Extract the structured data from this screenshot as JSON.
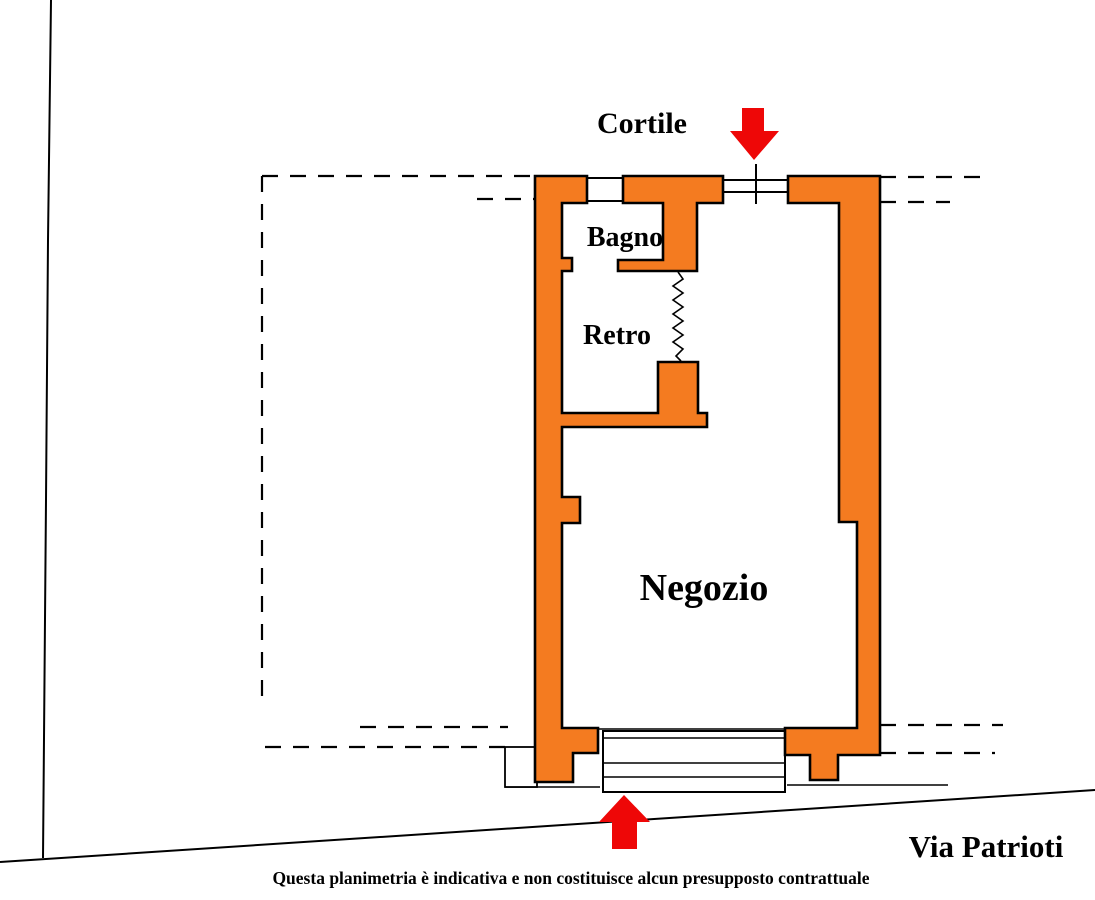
{
  "plan": {
    "labels": {
      "courtyard": "Cortile",
      "bathroom": "Bagno",
      "back_room": "Retro",
      "shop": "Negozio",
      "street": "Via Patrioti"
    },
    "disclaimer": "Questa planimetria è indicativa e non costituisce alcun presupposto contrattuale"
  },
  "colors": {
    "wall_fill": "#F47B20",
    "wall_outline": "#000000",
    "arrow_red": "#EE0707",
    "disclaimer_blue": "#2233BB"
  }
}
